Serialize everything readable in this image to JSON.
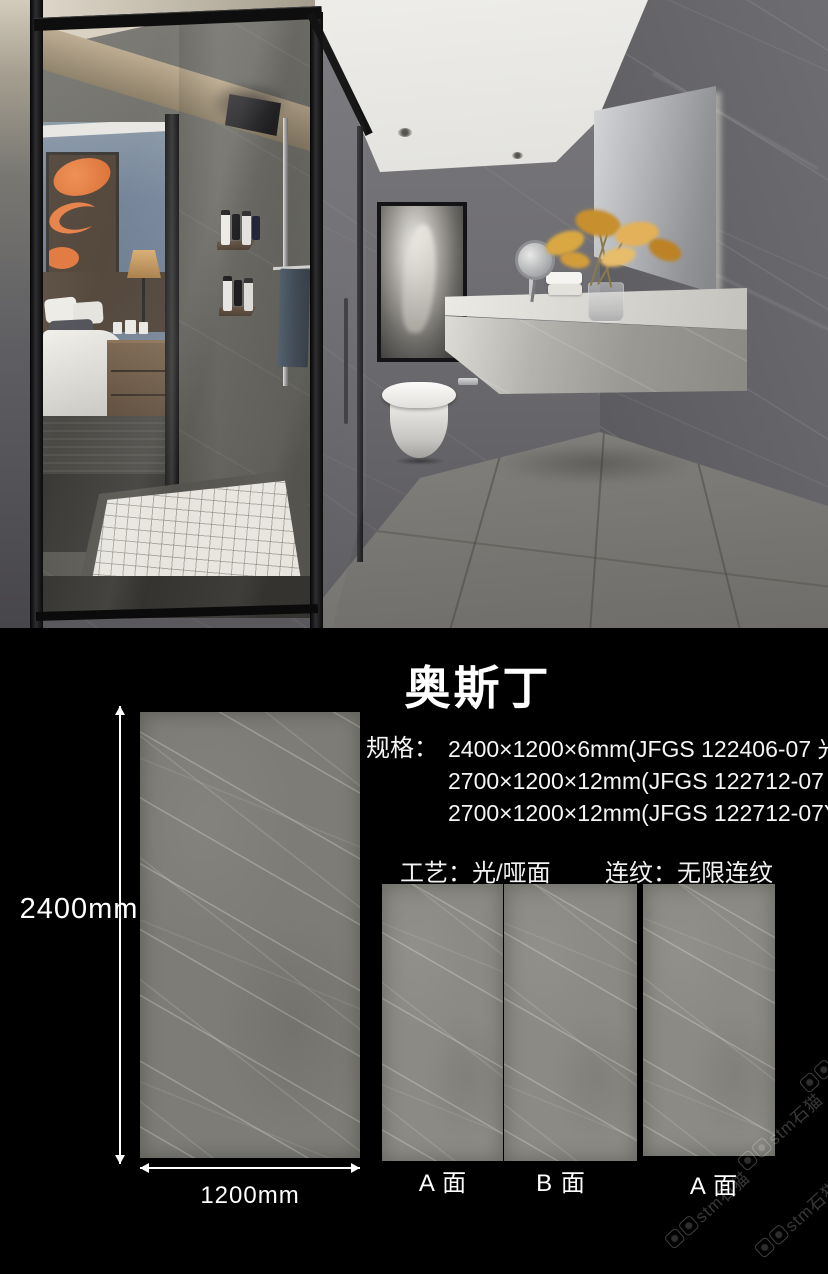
{
  "product": {
    "title": "奥斯丁",
    "spec_label": "规格：",
    "specs": [
      "2400×1200×6mm(JFGS 122406-07 光)",
      "2700×1200×12mm(JFGS 122712-07 光)",
      "2700×1200×12mm(JFGS 122712-07Y 哑)"
    ],
    "craft_label": "工艺：",
    "craft_value": "光/哑面",
    "pattern_label": "连纹：",
    "pattern_value": "无限连纹",
    "height_label": "2400mm",
    "width_label": "1200mm",
    "faces": [
      "A 面",
      "B 面",
      "A 面"
    ],
    "watermark_text": "stm石猫"
  },
  "colors": {
    "background": "#000000",
    "text": "#ffffff",
    "stone_large": "#7d7c76",
    "stone_small": "#8b8a84",
    "accent_flower": "#d9a843"
  }
}
